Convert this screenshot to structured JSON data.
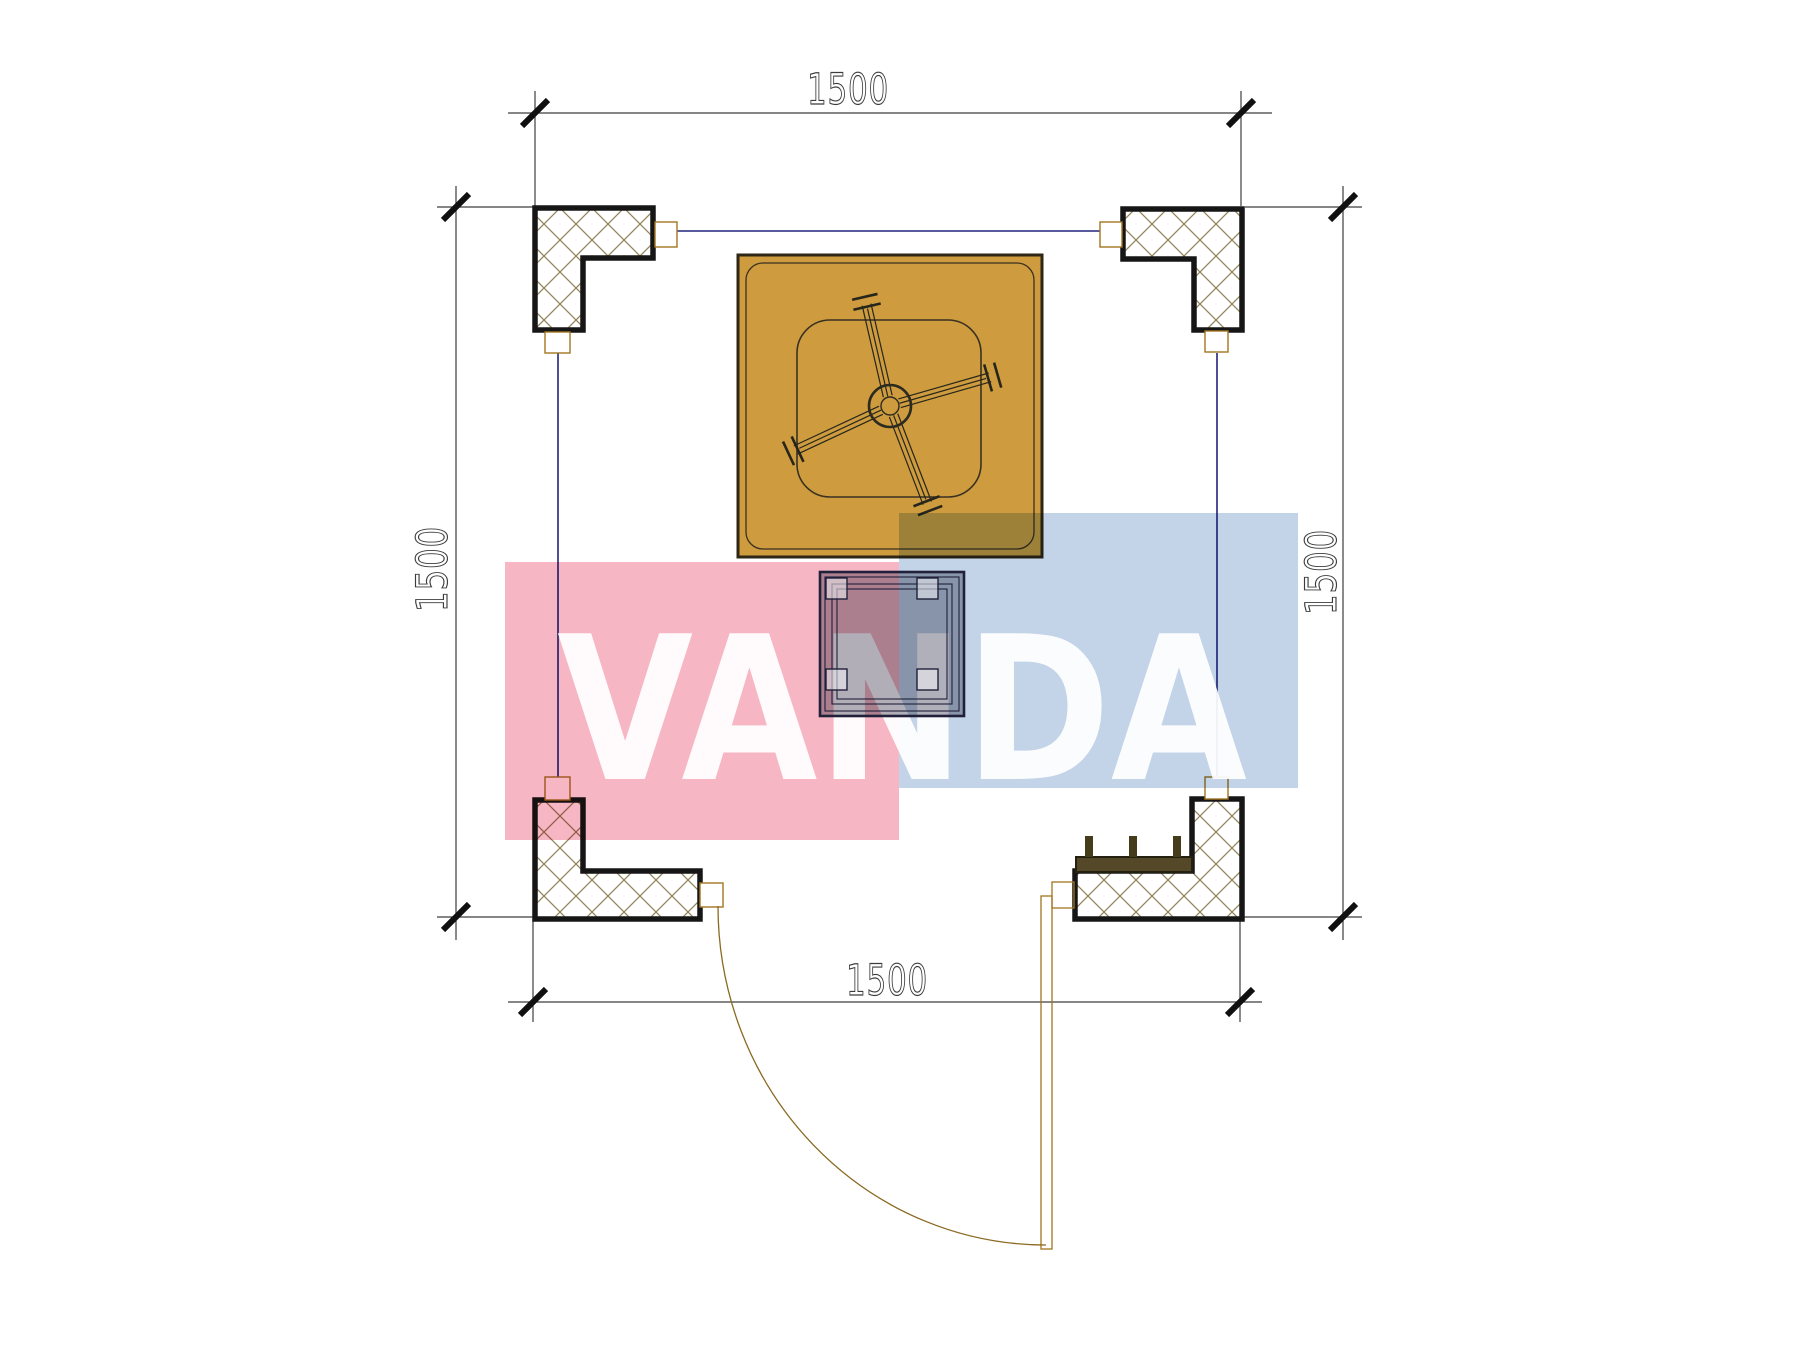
{
  "page": {
    "type": "architectural floor plan drawing",
    "background": "#ffffff"
  },
  "dimensions": {
    "top_label": "1500",
    "bottom_label": "1500",
    "left_label": "1500",
    "right_label": "1500"
  },
  "watermark": {
    "text": "VANDA",
    "pink_block_color": "#F6B6C3",
    "blue_block_color": "#C3D4E8",
    "text_color": "rgba(255,255,255,0.93)"
  },
  "plan": {
    "fan_fill": "#CE9B3E",
    "bench_fill": "#554829",
    "post_fill": "#453C1C",
    "link_line_color": "#23237E",
    "door_line_color": "#A2751F",
    "hatch_line_color": "#93835A",
    "table_fill": "#B2B2BA",
    "elements": [
      "corner-column-top-left",
      "corner-column-top-right",
      "corner-column-bottom-left",
      "corner-column-bottom-right",
      "ceiling-fan-unit",
      "table",
      "bench",
      "door-swing"
    ]
  }
}
